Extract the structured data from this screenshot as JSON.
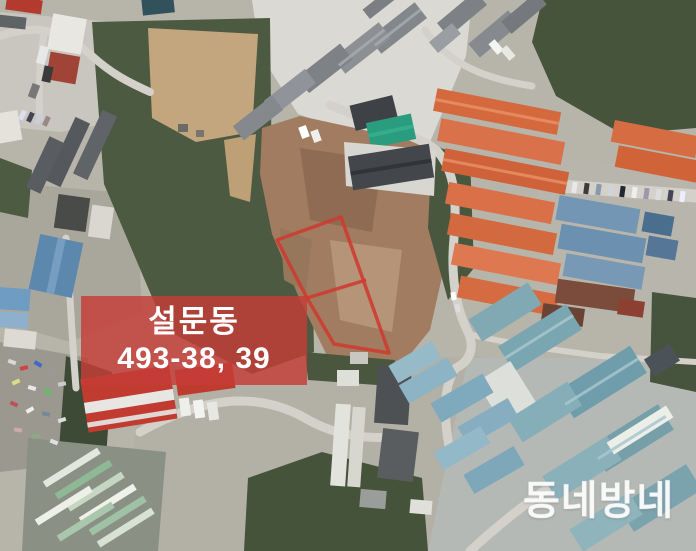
{
  "page": {
    "kind": "aerial-satellite-photo-with-parcel-annotation",
    "width": 696,
    "height": 551
  },
  "annotation": {
    "parcel_label": {
      "line1": "설문동",
      "line2": "493-38, 39"
    },
    "parcel": {
      "dong": "설문동",
      "lots": [
        "493-38",
        "493-39"
      ],
      "sections": 2
    },
    "colors": {
      "label-background": "rgba(197,61,55,0.82)",
      "label-text": "#ffffff",
      "parcel-outline": "#ce3a30"
    }
  },
  "watermark": {
    "text": "동네방네",
    "color": "rgba(255,255,255,0.6)"
  }
}
